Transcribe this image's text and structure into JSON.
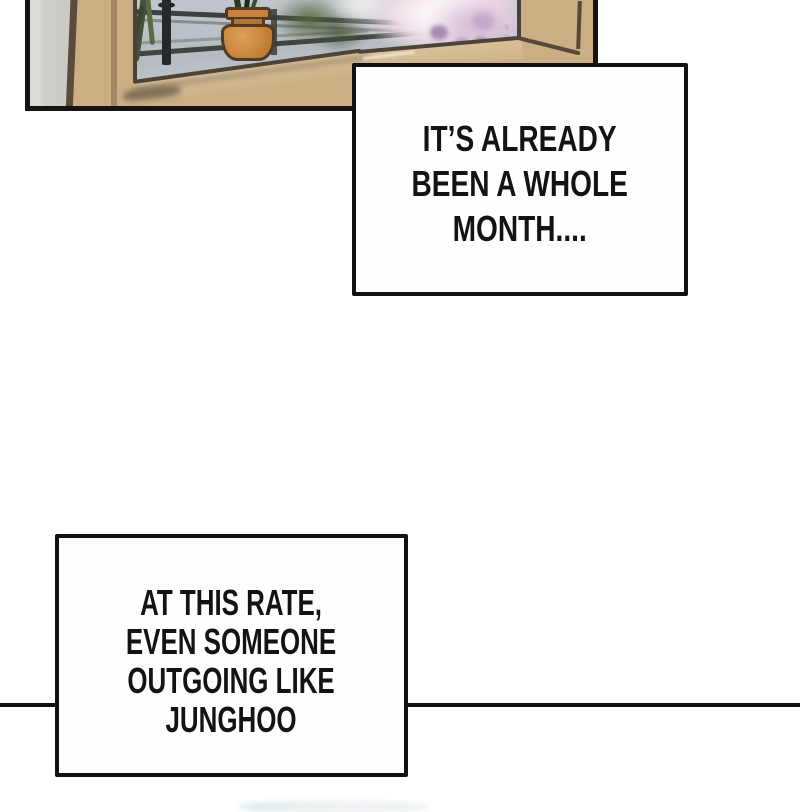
{
  "page": {
    "type": "webtoon comic page segment",
    "background": "#ffffff"
  },
  "captions": {
    "first": {
      "lines": [
        "IT’S ALREADY",
        "BEEN A WHOLE",
        "MONTH...."
      ]
    },
    "second": {
      "lines": [
        "AT THIS RATE,",
        "EVEN SOMEONE",
        "OUTGOING LIKE",
        "JUNGHOO"
      ]
    }
  },
  "illustration": {
    "alt": "window sill with a potted plant, metal railing and blurred cherry blossoms outside"
  },
  "palette": {
    "ink": "#131110",
    "caption_fill": "#ffffff",
    "caption_text": "#151312",
    "frame_tan": "#cbae83",
    "wall_gray": "#d4d2cc",
    "window_gray": "#b7bec4",
    "pot_orange": "#cf8c3e",
    "leaf_green": "#52613c",
    "blossom_pink": "#e9d4e3",
    "blossom_purple": "#ab8bb0"
  }
}
